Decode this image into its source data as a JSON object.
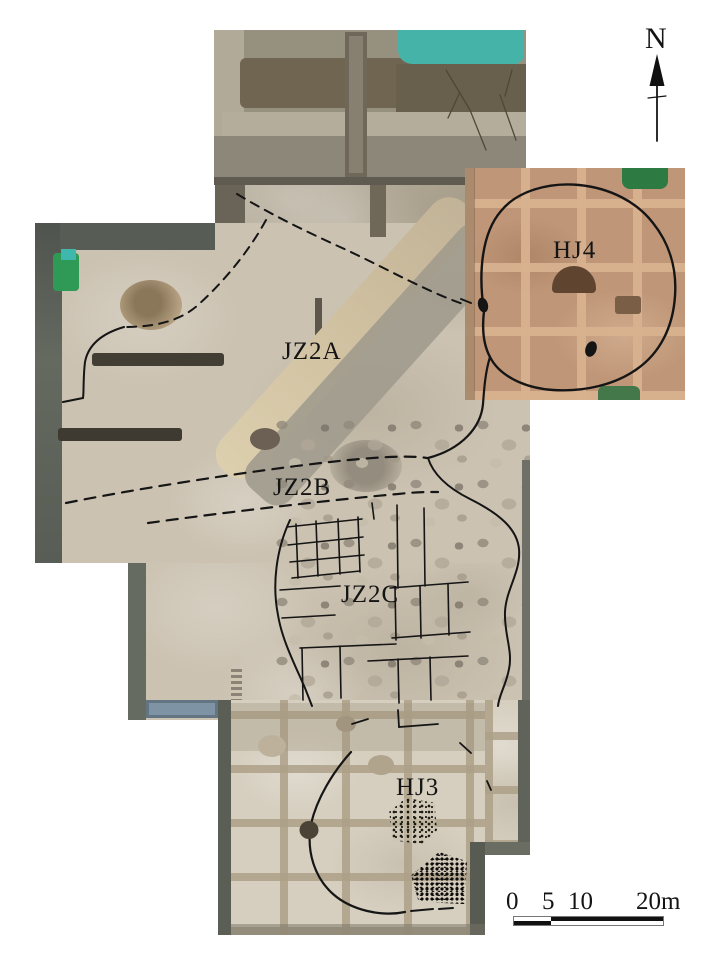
{
  "figure": {
    "description": "Aerial orthophoto of an archaeological excavation area with annotated building zones, feature outlines, north arrow and scale bar"
  },
  "labels": [
    {
      "text": "JZ2A"
    },
    {
      "text": "JZ2B"
    },
    {
      "text": "JZ2C"
    },
    {
      "text": "HJ4"
    },
    {
      "text": "HJ3"
    }
  ],
  "north_arrow": {
    "label": "N"
  },
  "scale_bar": {
    "tick_labels": [
      "0",
      "5",
      "10",
      "20m"
    ]
  },
  "colors": {
    "annotation_line": "#151515",
    "soil_tan": "#cbc2b1",
    "hj4_brown": "#bf9678",
    "pond_teal": "#45b3a8",
    "vegetation_green": "#2f9a55",
    "baulk_dark": "#5c615b"
  }
}
